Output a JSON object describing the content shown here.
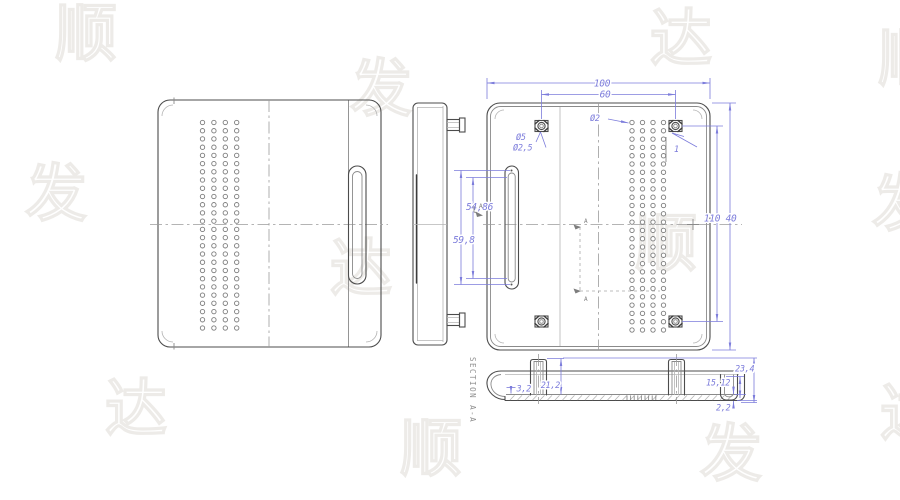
{
  "drawing": {
    "dimensions": {
      "overall_width": "100",
      "boss_spacing_h": "60",
      "vent_hole_dia": "Ø2",
      "boss_dia": "Ø5",
      "boss_hole_dia": "Ø2,5",
      "overall_height": "110",
      "boss_offset_v": "40",
      "chamfer": "1",
      "slot_len_inner": "54,86",
      "slot_len_outer": "59,8",
      "hook_gap": "3,2",
      "rib_height": "21,2",
      "total_height": "23,4",
      "cavity_height": "15,12",
      "bottom_wall": "2,2"
    },
    "section": {
      "label": "SECTION A-A",
      "cut_label": "A"
    },
    "views": {
      "front": {
        "dot_grid": {
          "cols": 4,
          "rows": 26
        }
      },
      "back": {
        "dot_grid": {
          "cols": 4,
          "rows": 26
        }
      }
    },
    "colors": {
      "dimension": "#7c7cdb",
      "line_dark": "#4c4c4c",
      "line_medium": "#8a8a8a",
      "line_light": "#b4b4b4",
      "watermark": "#edebe8"
    },
    "watermark_glyphs": [
      "顺",
      "发",
      "达"
    ]
  }
}
